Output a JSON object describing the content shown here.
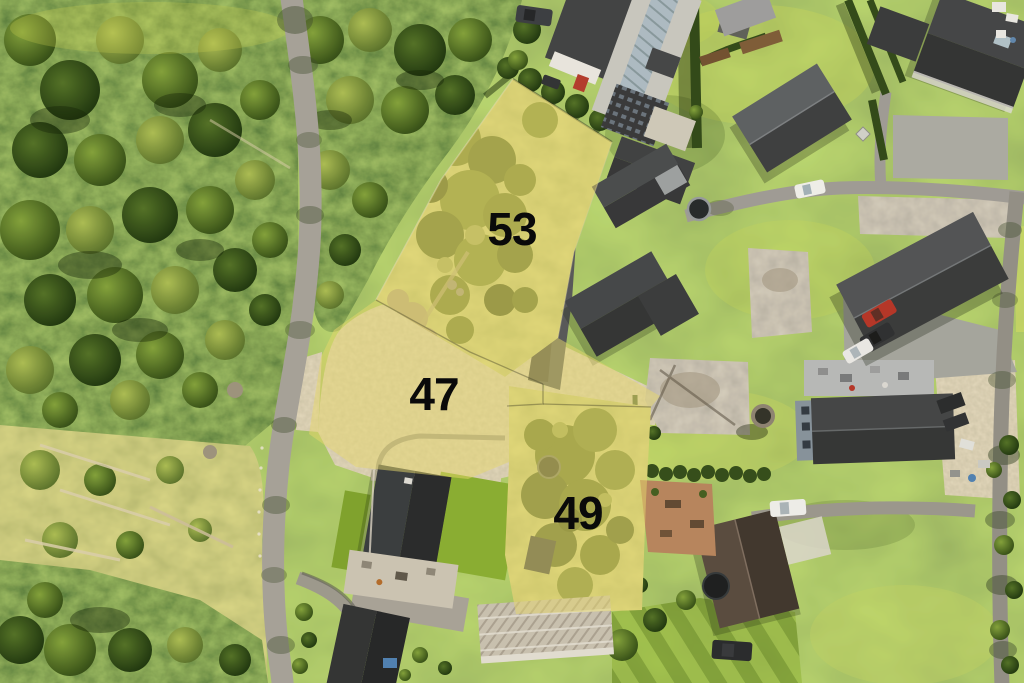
{
  "photo": {
    "plots": [
      {
        "id": "plot-53",
        "label": "53"
      },
      {
        "id": "plot-47",
        "label": "47"
      },
      {
        "id": "plot-49",
        "label": "49"
      }
    ],
    "colors": {
      "plot_overlay": "#e6d96e",
      "plot_label": "#0a0a0a",
      "forest_green": "#3c5c1f",
      "lawn_green": "#7fa22c",
      "road_gray": "#a3a19b",
      "roof_dark": "#33373b",
      "gravel_tan": "#b7a880",
      "asphalt_dark": "#53565a"
    }
  }
}
